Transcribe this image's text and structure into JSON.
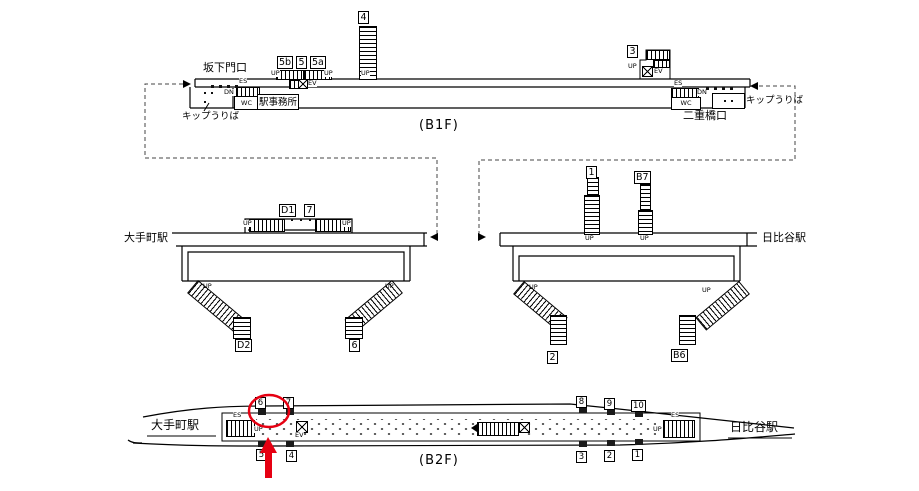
{
  "labels": {
    "up": "UP",
    "dn": "DN",
    "es": "ES",
    "wc": "WC",
    "ev": "EV"
  },
  "b1f": {
    "caption": "(B1F)",
    "exit_sakashitamon": "坂下門口",
    "exit_nijubashi": "二重橋口",
    "station_office": "駅事務所",
    "ticket_office_left": "キップうりば",
    "ticket_office_right": "キップうりば",
    "boxes": {
      "b4": "4",
      "b5b": "5b",
      "b5": "5",
      "b5a": "5a",
      "b3": "3"
    }
  },
  "mezzanine_left": {
    "station": "大手町駅",
    "boxes": {
      "d1": "D1",
      "n7": "7",
      "d2": "D2",
      "n6": "6"
    }
  },
  "mezzanine_right": {
    "station": "日比谷駅",
    "boxes": {
      "n1": "1",
      "b7": "B7",
      "n2": "2",
      "b6": "B6"
    }
  },
  "b2f": {
    "caption": "(B2F)",
    "station_left": "大手町駅",
    "station_right": "日比谷駅",
    "top_positions": [
      "6",
      "7",
      "8",
      "9",
      "10"
    ],
    "bottom_positions": [
      "5",
      "4",
      "3",
      "2",
      "1"
    ],
    "highlighted_position": "6"
  },
  "annotation": {
    "color": "#e60012"
  }
}
